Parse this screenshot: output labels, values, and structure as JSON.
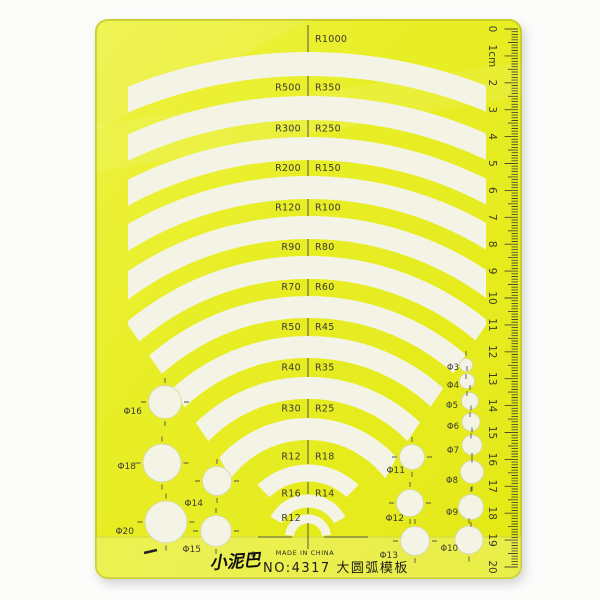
{
  "product": {
    "brand_logo": "小泥巴",
    "registered_mark": "®",
    "model_text": "NO:4317 大圆弧模板",
    "made_in_text": "MADE IN CHINA"
  },
  "arc_rows": [
    {
      "left": "",
      "right": "R1000"
    },
    {
      "left": "R500",
      "right": "R350"
    },
    {
      "left": "R300",
      "right": "R250"
    },
    {
      "left": "R200",
      "right": "R150"
    },
    {
      "left": "R120",
      "right": "R100"
    },
    {
      "left": "R90",
      "right": "R80"
    },
    {
      "left": "R70",
      "right": "R60"
    },
    {
      "left": "R50",
      "right": "R45"
    },
    {
      "left": "R40",
      "right": "R35"
    },
    {
      "left": "R30",
      "right": "R25"
    },
    {
      "left": "R12",
      "right": "R18"
    },
    {
      "left": "R16",
      "right": "R14"
    },
    {
      "left": "R12",
      "right": ""
    }
  ],
  "circles": {
    "left": [
      "Φ16",
      "Φ18",
      "Φ20",
      "Φ14",
      "Φ15"
    ],
    "right_mid": [
      "Φ11",
      "Φ12",
      "Φ13"
    ],
    "right_small": [
      "Φ3",
      "Φ4",
      "Φ5",
      "Φ6",
      "Φ7",
      "Φ8",
      "Φ9",
      "Φ10"
    ]
  },
  "ruler": {
    "marks": [
      "0",
      "1cm",
      "2",
      "3",
      "4",
      "5",
      "6",
      "7",
      "8",
      "9",
      "10",
      "11",
      "12",
      "13",
      "14",
      "15",
      "16",
      "17",
      "18",
      "19",
      "20"
    ]
  },
  "colors": {
    "plate_yellow": "#e8ee28",
    "hole_white": "#f4f4e6",
    "ink": "#3a3a30"
  }
}
